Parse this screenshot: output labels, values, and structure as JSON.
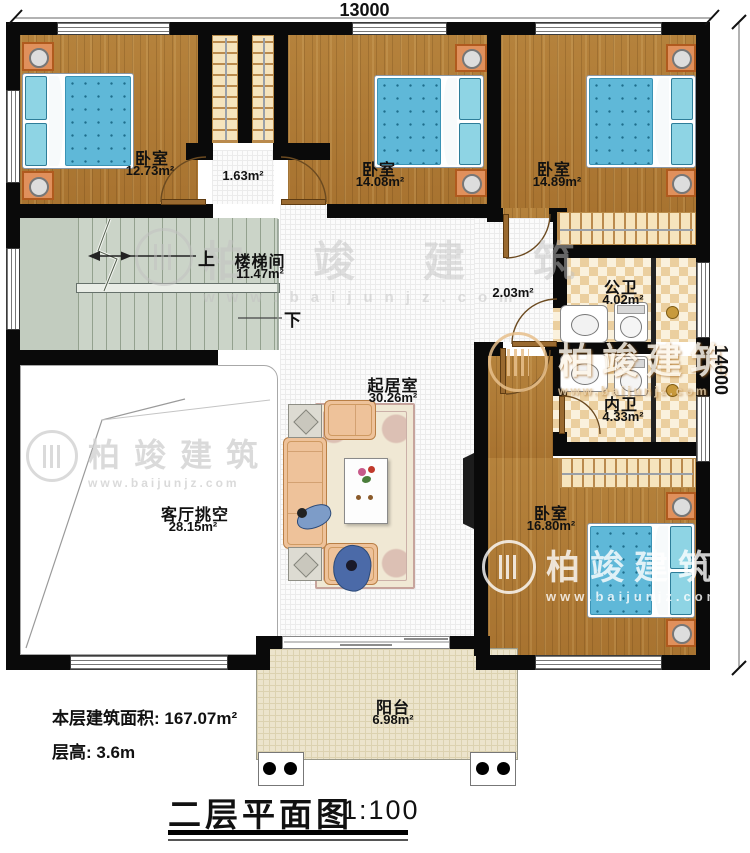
{
  "plan": {
    "dim_top": "13000",
    "dim_right": "14000",
    "title": "二层平面图",
    "scale": "1:100",
    "footer_area": "本层建筑面积: 167.07m²",
    "footer_height": "层高: 3.6m"
  },
  "watermark": {
    "brand": "柏竣建筑",
    "url": "www.baijunjz.com"
  },
  "rooms": {
    "bedroom1": {
      "name": "卧室",
      "area": "12.73m²"
    },
    "closet_hall": {
      "area": "1.63m²"
    },
    "bedroom2": {
      "name": "卧室",
      "area": "14.08m²"
    },
    "bedroom3": {
      "name": "卧室",
      "area": "14.89m²"
    },
    "stairwell": {
      "name": "楼梯间",
      "area": "11.47m²",
      "up": "上",
      "down": "下"
    },
    "hallway": {
      "area": "2.03m²"
    },
    "public_bath": {
      "name": "公卫",
      "area": "4.02m²"
    },
    "ensuite_bath": {
      "name": "内卫",
      "area": "4.33m²"
    },
    "living": {
      "name": "起居室",
      "area": "30.26m²"
    },
    "void": {
      "name": "客厅挑空",
      "area": "28.15m²"
    },
    "bedroom4": {
      "name": "卧室",
      "area": "16.80m²"
    },
    "balcony": {
      "name": "阳台",
      "area": "6.98m²"
    }
  }
}
